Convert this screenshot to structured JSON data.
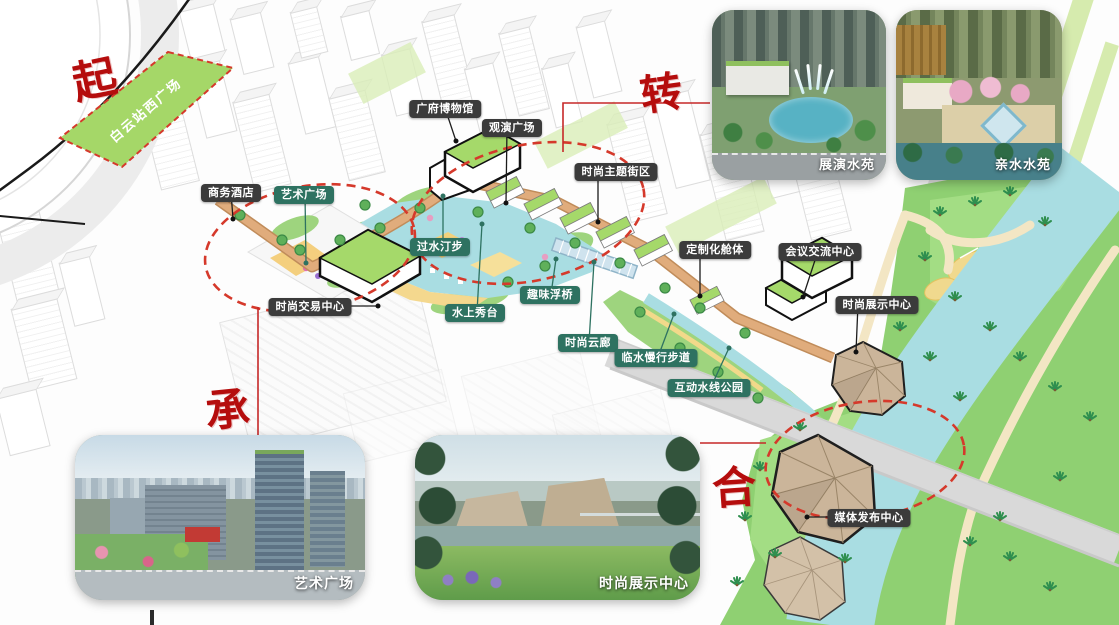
{
  "site_plaza": {
    "label": "白云站西广场"
  },
  "sequence": {
    "qi": "起",
    "zhuan": "转",
    "cheng": "承",
    "he": "合"
  },
  "markers_dark": [
    {
      "id": "business-hotel",
      "text": "商务酒店"
    },
    {
      "id": "guangfu-museum",
      "text": "广府博物馆"
    },
    {
      "id": "performance-plaza",
      "text": "观演广场"
    },
    {
      "id": "fashion-theme-street",
      "text": "时尚主题街区"
    },
    {
      "id": "fashion-trade-center",
      "text": "时尚交易中心"
    },
    {
      "id": "custom-pods",
      "text": "定制化舱体"
    },
    {
      "id": "conference-center",
      "text": "会议交流中心"
    },
    {
      "id": "fashion-expo-center",
      "text": "时尚展示中心"
    },
    {
      "id": "media-release-center",
      "text": "媒体发布中心"
    }
  ],
  "markers_teal": [
    {
      "id": "art-plaza",
      "text": "艺术广场"
    },
    {
      "id": "stepping-stones",
      "text": "过水汀步"
    },
    {
      "id": "water-stage",
      "text": "水上秀台"
    },
    {
      "id": "fun-floating-bridge",
      "text": "趣味浮桥"
    },
    {
      "id": "fashion-cloud-gallery",
      "text": "时尚云廊"
    },
    {
      "id": "waterfront-walkway",
      "text": "临水慢行步道"
    },
    {
      "id": "interactive-water-park",
      "text": "互动水线公园"
    }
  ],
  "insets": [
    {
      "caption": "展演水苑"
    },
    {
      "caption": "亲水水苑"
    },
    {
      "caption": "艺术广场"
    },
    {
      "caption": "时尚展示中心"
    }
  ],
  "colors": {
    "accent_red": "#b50d0d",
    "dashed_red": "#d5392b",
    "badge_dark_bg": "#3b3b3b",
    "badge_teal_bg": "#2e7261",
    "site_green": "#a5d768",
    "corridor_orange": "#dba473",
    "water_blue": "#a9dde2",
    "park_green": "#8fd072",
    "pavilion_tan": "#cbb59a",
    "roof_green": "#a5d96a"
  }
}
